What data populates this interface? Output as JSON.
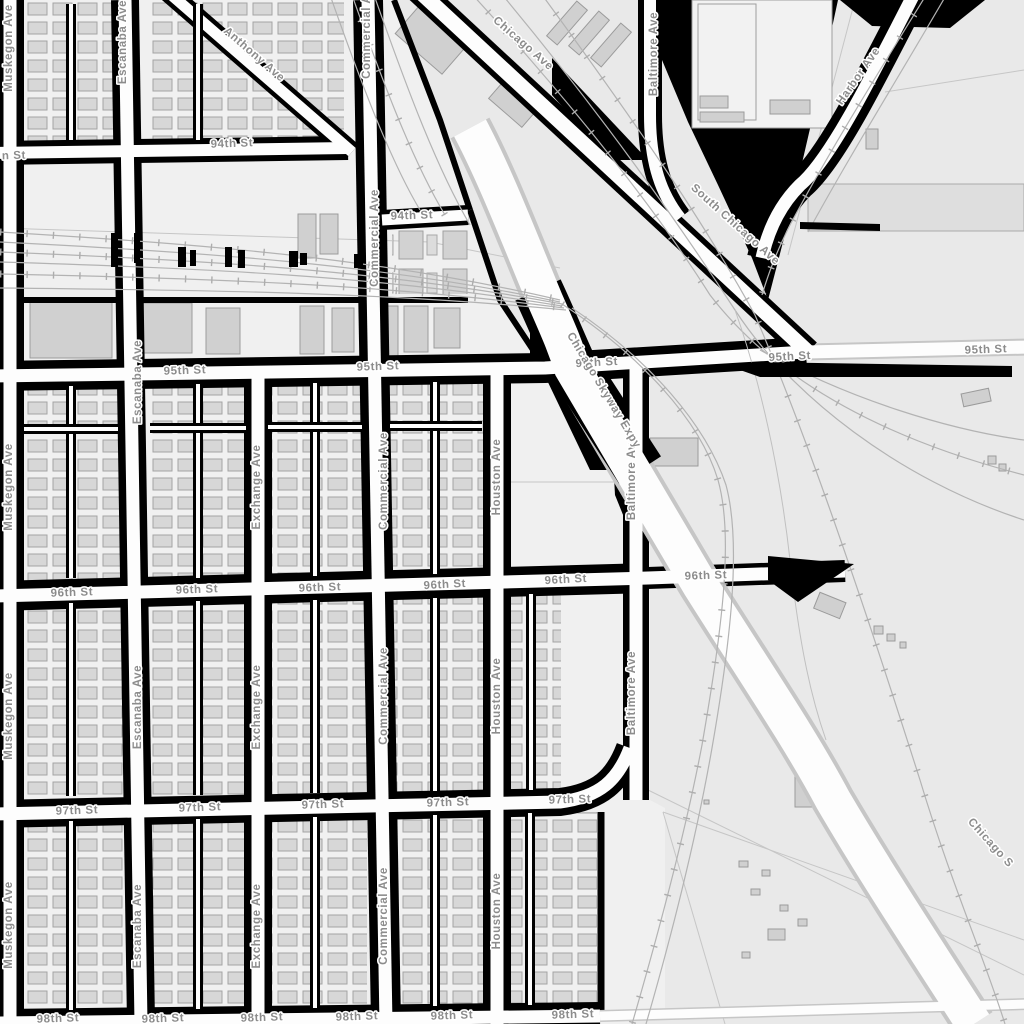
{
  "map": {
    "kind": "grayscale street map (South Chicago area)",
    "labels": {
      "st94": "94th St",
      "st95": "95th St",
      "st96": "96th St",
      "st97": "97th St",
      "st98": "98th St",
      "st_partial_left": "n St",
      "muskegon": "Muskegon Ave",
      "escanaba": "Escanaba Ave",
      "exchange": "Exchange Ave",
      "commercial": "Commercial Ave",
      "houston": "Houston Ave",
      "baltimore": "Baltimore Ave",
      "anthony": "Anthony Ave",
      "chicago_ave": "Chicago Ave",
      "south_chicago": "South Chicago Ave",
      "harbor": "Harbor Ave",
      "skyway": "Chicago Skyway Expy",
      "skyway_partial": "Chicago S"
    },
    "colors": {
      "land": "#e9e9e9",
      "block_fill": "#f0f0f0",
      "road_fill": "#fdfdfd",
      "block_border": "#000000",
      "building": "#d7d7d7",
      "railway": "#b3b3b3",
      "label_text": "#8c8c8c",
      "parcel": "#dedede"
    }
  }
}
